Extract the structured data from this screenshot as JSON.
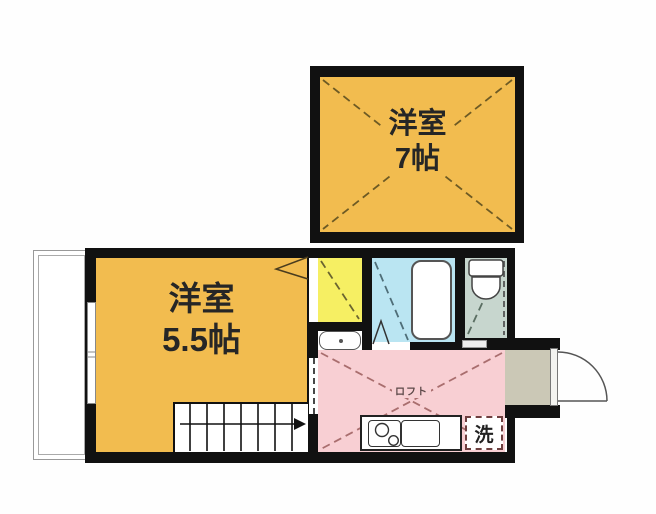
{
  "plan_title": "apartment floor plan",
  "rooms": {
    "upper": {
      "name": "洋室",
      "size": "7帖",
      "color": "#F2BC4F"
    },
    "lower": {
      "name": "洋室",
      "size": "5.5帖",
      "color": "#F2BC4F"
    },
    "loft": {
      "name": "ロフト",
      "color": "#F8CFD3"
    },
    "laundry": {
      "name": "洗"
    },
    "closet": {
      "color": "#F6EF63"
    },
    "bathroom": {
      "color": "#BAE5F2"
    },
    "toilet": {
      "color": "#C7D6CE"
    },
    "entrance": {
      "color": "#CBC8B6"
    }
  },
  "wall_color": "#111111"
}
